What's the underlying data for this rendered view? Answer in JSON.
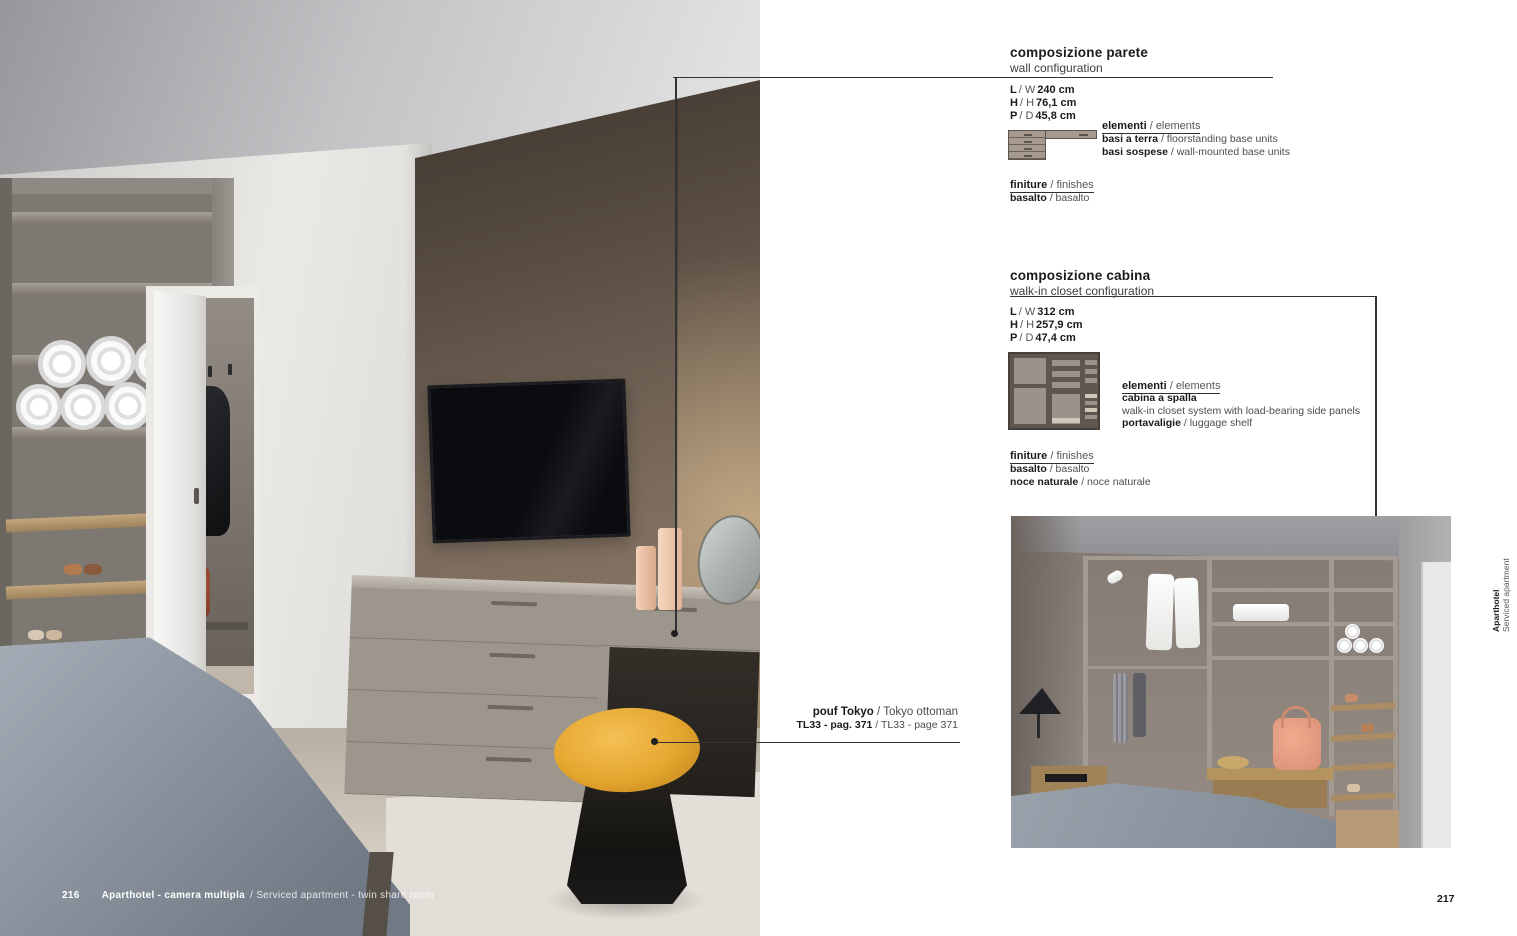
{
  "colors": {
    "accent_yellow": "#e5a62f",
    "wall_brown": "#7b6b5d",
    "text_dark": "#1a1a1a",
    "text_light": "#4d4d4d",
    "caption_white": "#ffffff"
  },
  "left_page": {
    "page_number": "216",
    "caption_bold": "Aparthotel - camera multipla",
    "caption_light": "/ Serviced apartment - twin share room"
  },
  "right_page": {
    "page_number": "217",
    "side_tab": {
      "title": "Aparthotel",
      "subtitle": "Serviced apartment"
    },
    "pouf_callout": {
      "line1_bold": "pouf Tokyo",
      "line1_light": "/ Tokyo ottoman",
      "line2_bold": "TL33 - pag. 371",
      "line2_light": "/ TL33 - page 371"
    },
    "wall_section": {
      "title": "composizione parete",
      "subtitle": "wall configuration",
      "dimensions": [
        {
          "bold": "L",
          "mid": "/ W",
          "value": "240 cm"
        },
        {
          "bold": "H",
          "mid": "/ H",
          "value": "76,1 cm"
        },
        {
          "bold": "P",
          "mid": "/ D",
          "value": "45,8 cm"
        }
      ],
      "elements_heading_bold": "elementi",
      "elements_heading_light": "/ elements",
      "elements": [
        {
          "bold": "basi a terra",
          "light": "/ floorstanding base units"
        },
        {
          "bold": "basi sospese",
          "light": "/ wall-mounted base units"
        }
      ],
      "finishes_heading_bold": "finiture",
      "finishes_heading_light": "/ finishes",
      "finishes": [
        {
          "bold": "basalto",
          "light": "/ basalto"
        }
      ],
      "diagram_icon": "dresser-with-wall-unit-diagram"
    },
    "closet_section": {
      "title": "composizione cabina",
      "subtitle": "walk-in closet configuration",
      "dimensions": [
        {
          "bold": "L",
          "mid": "/ W",
          "value": "312 cm"
        },
        {
          "bold": "H",
          "mid": "/ H",
          "value": "257,9 cm"
        },
        {
          "bold": "P",
          "mid": "/ D",
          "value": "47,4 cm"
        }
      ],
      "elements_heading_bold": "elementi",
      "elements_heading_light": "/ elements",
      "elements": [
        {
          "bold": "cabina a spalla",
          "light": ""
        },
        {
          "bold": "",
          "light": "walk-in closet system with load-bearing side panels"
        },
        {
          "bold": "portavaligie",
          "light": "/ luggage shelf"
        }
      ],
      "finishes_heading_bold": "finiture",
      "finishes_heading_light": "/ finishes",
      "finishes": [
        {
          "bold": "basalto",
          "light": "/ basalto"
        },
        {
          "bold": "noce naturale",
          "light": "/ noce naturale"
        }
      ],
      "diagram_icon": "walk-in-closet-front-diagram"
    }
  }
}
